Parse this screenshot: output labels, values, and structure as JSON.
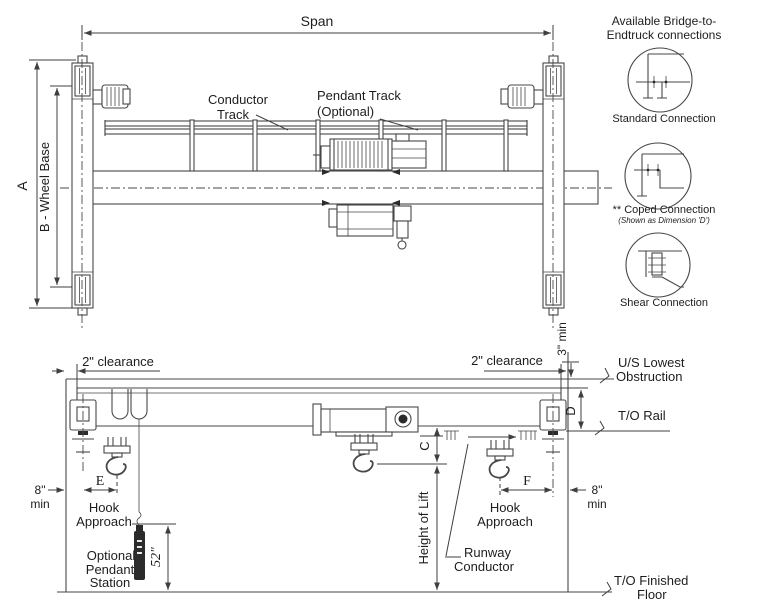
{
  "colors": {
    "line": "#474747",
    "text": "#1d1d1d",
    "background": "#ffffff"
  },
  "plan": {
    "span": "Span",
    "dim_a": "A",
    "wheel_base": "B - Wheel Base",
    "conductor_track": [
      "Conductor",
      "Track"
    ],
    "pendant_track": [
      "Pendant Track",
      "(Optional)"
    ]
  },
  "connections": {
    "heading": [
      "Available Bridge-to-",
      "Endtruck connections"
    ],
    "items": [
      {
        "label": "Standard Connection"
      },
      {
        "label": "** Coped Connection",
        "note": "(Shown as Dimension 'D')"
      },
      {
        "label": "Shear Connection"
      }
    ]
  },
  "elevation": {
    "clearance_left": "2\" clearance",
    "clearance_right": "2\" clearance",
    "min3": "3\" min",
    "us_lowest": [
      "U/S Lowest",
      "Obstruction"
    ],
    "dim_d": "D",
    "to_rail": "T/O Rail",
    "dim_c": "C",
    "dim_e": "E",
    "dim_f": "F",
    "min8_left": [
      "8\"",
      "min"
    ],
    "min8_right": [
      "8\"",
      "min"
    ],
    "hook_approach_left": [
      "Hook",
      "Approach"
    ],
    "hook_approach_right": [
      "Hook",
      "Approach"
    ],
    "height_of_lift": "Height of Lift",
    "runway_conductor": [
      "Runway",
      "Conductor"
    ],
    "pendant_station": [
      "Optional",
      "Pendant",
      "Station"
    ],
    "pendant_height": "52\"",
    "finished_floor": [
      "T/O Finished",
      "Floor"
    ]
  }
}
